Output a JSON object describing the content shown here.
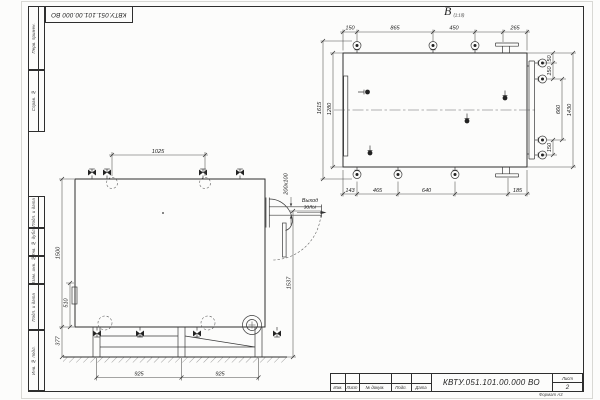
{
  "document": {
    "number": "КВТУ.051.101.00.000  ВО",
    "stamp": "КВТУ.051.101.00.000  ВО",
    "sheet_label": "Лист",
    "sheet_number": "2",
    "format_note": "Формат  А3"
  },
  "title_block": {
    "c0": "Изм.",
    "c1": "Лист",
    "c2": "№ докум.",
    "c3": "Подп.",
    "c4": "Дата"
  },
  "margins": [
    "Перв. примен.",
    "Справ. №",
    "Подп. и дата",
    "Инв. № дубл.",
    "Взам. инв. №",
    "Подп. и дата",
    "Инв. № подл."
  ],
  "views": {
    "top": {
      "label": "В",
      "scale_note": "(1:10)"
    },
    "front": {
      "outlet_label_1": "Выход",
      "outlet_label_2": "золы"
    }
  },
  "dims": {
    "fv": {
      "top": "1025",
      "height": "1500",
      "mid": "510",
      "base": "377",
      "span1": "925",
      "span2": "925",
      "outlet": "1537",
      "duct": "200х100"
    },
    "tv": {
      "t1": "150",
      "t2": "865",
      "t3": "450",
      "t4": "265",
      "b1": "143",
      "b2": "465",
      "b3": "640",
      "b4": "185",
      "l1": "1615",
      "l2": "1280",
      "r1": "50",
      "r2": "150",
      "r3": "660",
      "r4": "150",
      "r5": "1430"
    }
  }
}
